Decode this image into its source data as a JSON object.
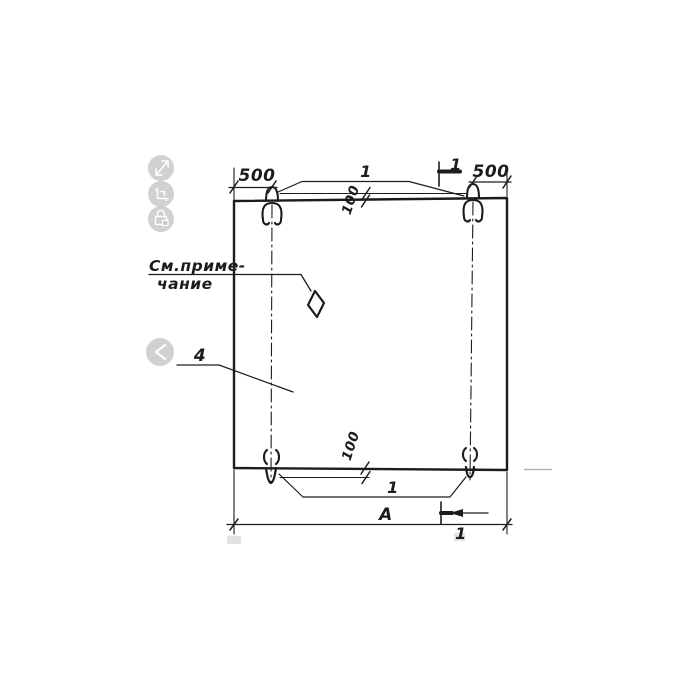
{
  "viewer": {
    "toolbar_icons": [
      {
        "name": "expand-icon"
      },
      {
        "name": "crop-icon"
      },
      {
        "name": "lock-icon"
      }
    ],
    "nav_previous_icon": "chevron-left-icon"
  },
  "drawing": {
    "dimensions": {
      "top_left_offset": "500",
      "top_right_offset": "500",
      "top_loop_height": "100",
      "bottom_loop_height": "100",
      "overall_width": "А"
    },
    "callouts": {
      "top_loops": "1",
      "bottom_loops": "1",
      "panel": "4",
      "note_line1": "См.приме-",
      "note_line2": "чание"
    },
    "sections": {
      "top_mark": "1",
      "bottom_mark": "1"
    }
  },
  "colors": {
    "ink": "#1c1c1c",
    "paper": "#ffffff",
    "icon_background": "#c9c9c9",
    "icon_glyph": "#ffffff",
    "faint_artifact": "#b5b5b5"
  }
}
